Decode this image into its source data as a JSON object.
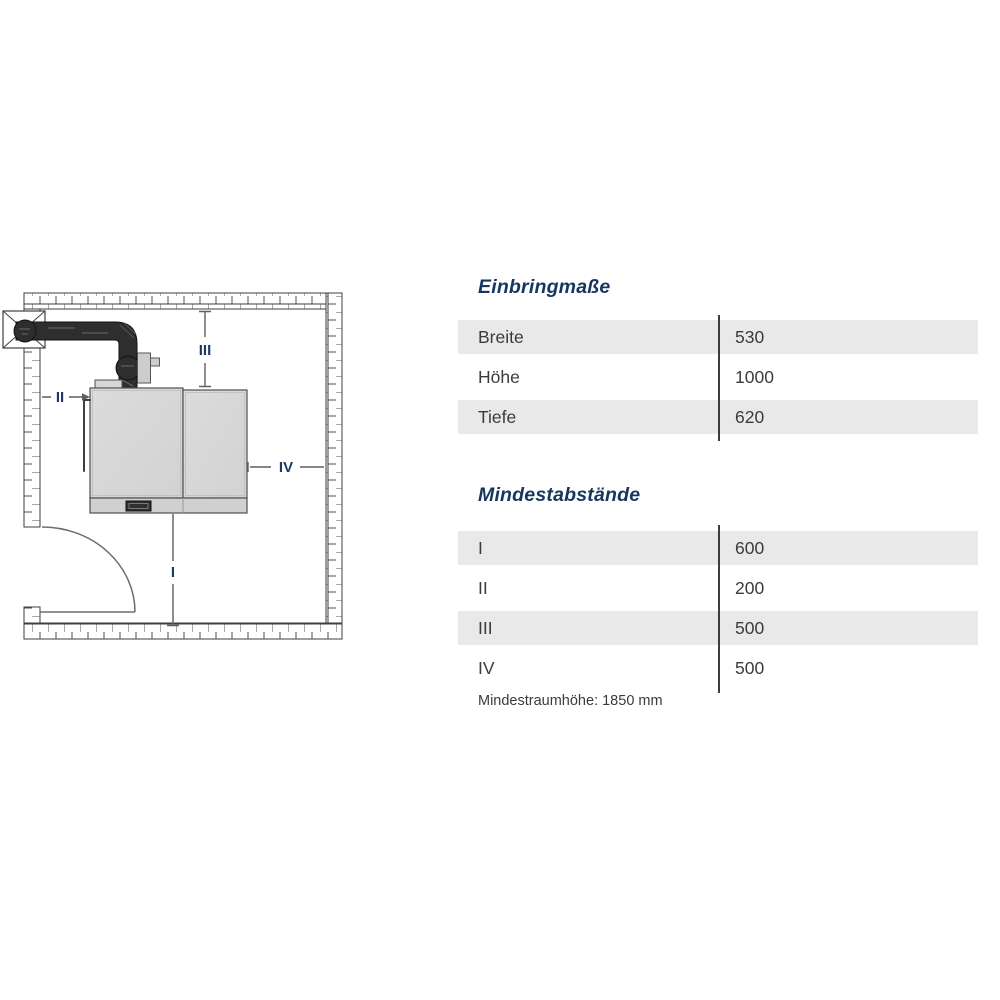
{
  "diagram": {
    "labels": {
      "I": "I",
      "II": "II",
      "III": "III",
      "IV": "IV"
    }
  },
  "einbringmasse": {
    "title": "Einbringmaße",
    "rows": [
      {
        "label": "Breite",
        "value": "530"
      },
      {
        "label": "Höhe",
        "value": "1000"
      },
      {
        "label": "Tiefe",
        "value": "620"
      }
    ]
  },
  "mindestabstaende": {
    "title": "Mindestabstände",
    "rows": [
      {
        "label": "I",
        "value": "600"
      },
      {
        "label": "II",
        "value": "200"
      },
      {
        "label": "III",
        "value": "500"
      },
      {
        "label": "IV",
        "value": "500"
      }
    ],
    "caption": "Mindestraumhöhe: 1850 mm"
  },
  "colors": {
    "heading_navy": "#16365e",
    "dim_label_navy": "#1b3a66",
    "row_gray": "#e9e9e9",
    "table_text": "#3b3b3b",
    "divider": "#3d3d3d",
    "flue_dark": "#2e2e2e",
    "boiler_gray": "#d7d7d7"
  }
}
